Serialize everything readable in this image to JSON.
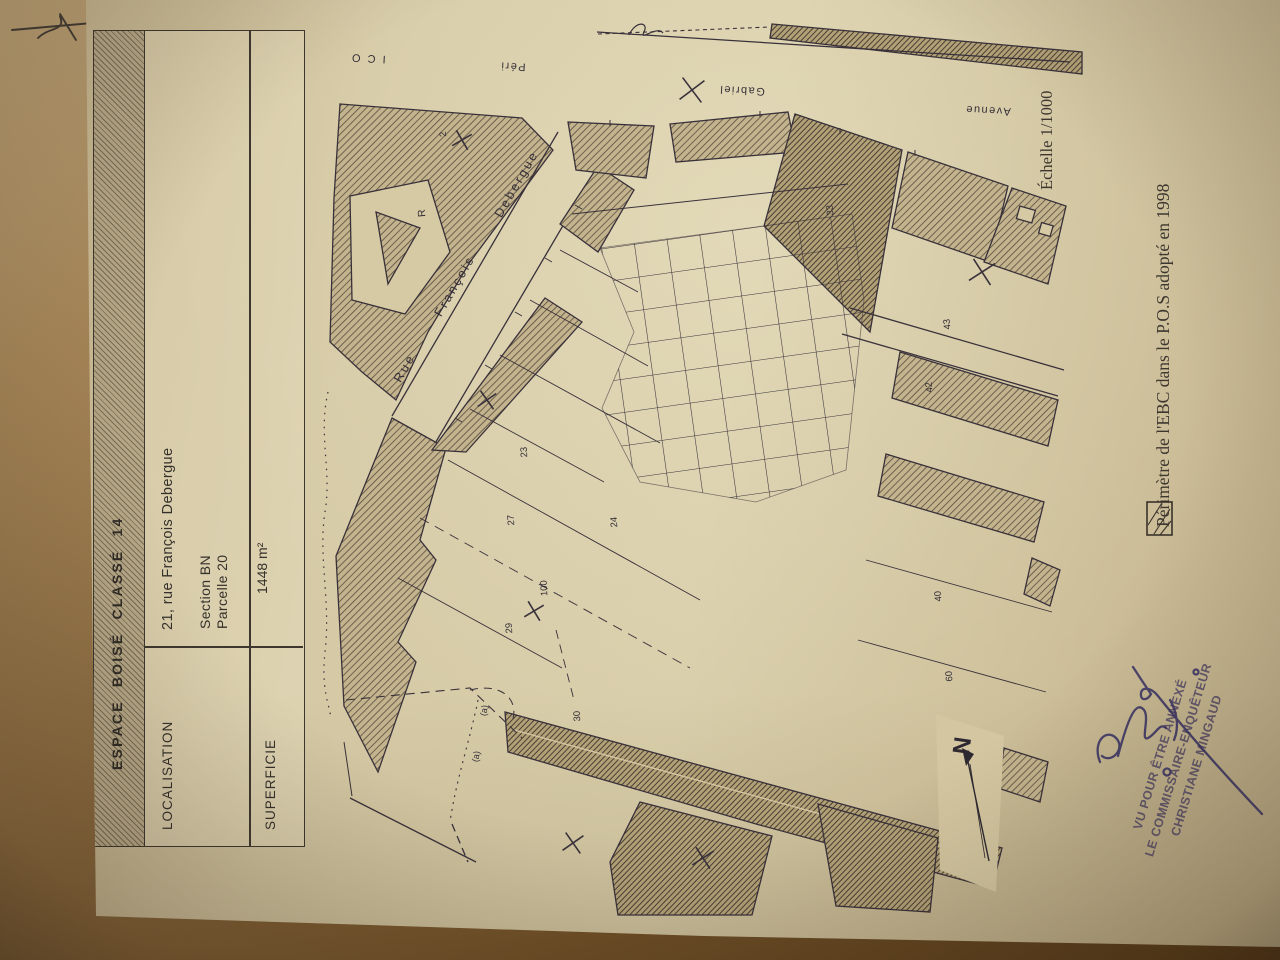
{
  "title_block": {
    "title": "ESPACE BOISÉ CLASSÉ 14",
    "rows": [
      {
        "label": "LOCALISATION",
        "line1": "21, rue François Debergue",
        "line2": "Section BN",
        "line3": "Parcelle 20"
      },
      {
        "label": "SUPERFICIE",
        "line1": "1448 m²"
      }
    ]
  },
  "annotations": {
    "scale": "Échelle 1/1000",
    "legend_text": "Périmètre de l'EBC dans le P.O.S adopté en 1998"
  },
  "stamp": {
    "line1": "VU POUR ÊTRE ANNEXÉ",
    "line2": "LE COMMISSAIRE-ENQUÊTEUR",
    "line3": "CHRISTIANE MINGAUD"
  },
  "map": {
    "north_label": "N",
    "street_labels": [
      {
        "text": "Rue"
      },
      {
        "text": "François"
      },
      {
        "text": "Debergue"
      },
      {
        "text": "Avenue"
      },
      {
        "text": "Gabriel"
      },
      {
        "text": "Péri"
      },
      {
        "text": "I C O"
      }
    ],
    "parcel_labels": [
      {
        "text": "2"
      },
      {
        "text": "R"
      },
      {
        "text": "23"
      },
      {
        "text": "27"
      },
      {
        "text": "29"
      },
      {
        "text": "100"
      },
      {
        "text": "24"
      },
      {
        "text": "30"
      },
      {
        "text": "(a)"
      },
      {
        "text": "(a)"
      },
      {
        "text": "33"
      },
      {
        "text": "43"
      },
      {
        "text": "42"
      },
      {
        "text": "40"
      },
      {
        "text": "60"
      }
    ]
  },
  "colors": {
    "paper": "#d5c8a3",
    "desk": "#7a5a30",
    "ink": "#39313a",
    "stamp_ink": "#574d68",
    "signature_ink": "#3a3466"
  }
}
